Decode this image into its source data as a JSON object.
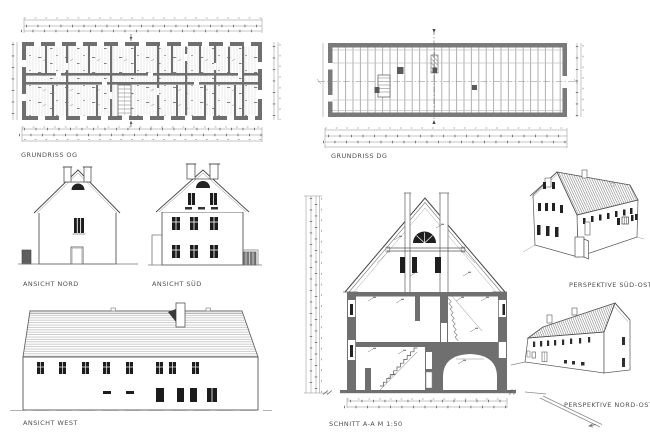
{
  "sheet": {
    "background": "#ffffff",
    "description_labels": {
      "grundriss_og": "GRUNDRISS OG",
      "grundriss_dg": "GRUNDRISS DG",
      "ansicht_nord": "ANSICHT NORD",
      "ansicht_sued": "ANSICHT SÜD",
      "ansicht_west": "ANSICHT WEST",
      "schnitt": "SCHNITT A-A M 1:50",
      "perspektive_so": "PERSPEKTIVE SÜD-OST",
      "perspektive_no": "PERSPEKTIVE NORD-OST"
    }
  },
  "drawings": {
    "grundriss_og": {
      "label": "GRUNDRISS OG",
      "type": "floor-plan"
    },
    "grundriss_dg": {
      "label": "GRUNDRISS DG",
      "type": "attic-floor-plan"
    },
    "ansicht_nord": {
      "label": "ANSICHT NORD",
      "type": "elevation"
    },
    "ansicht_sued": {
      "label": "ANSICHT SÜD",
      "type": "elevation"
    },
    "ansicht_west": {
      "label": "ANSICHT WEST",
      "type": "elevation"
    },
    "schnitt": {
      "label": "SCHNITT A-A M 1:50",
      "type": "section"
    },
    "perspektive_so": {
      "label": "PERSPEKTIVE SÜD-OST",
      "type": "perspective"
    },
    "perspektive_no": {
      "label": "PERSPEKTIVE NORD-OST",
      "type": "perspective"
    }
  },
  "palette": {
    "line": "#4a4a4a",
    "line_light": "#9a9a9a",
    "wall_poche": "#6f6f6f",
    "wall_dark": "#555555",
    "window_glass": "#1c1c1c",
    "roof_hatch": "#a8a8a8",
    "background": "#ffffff"
  }
}
